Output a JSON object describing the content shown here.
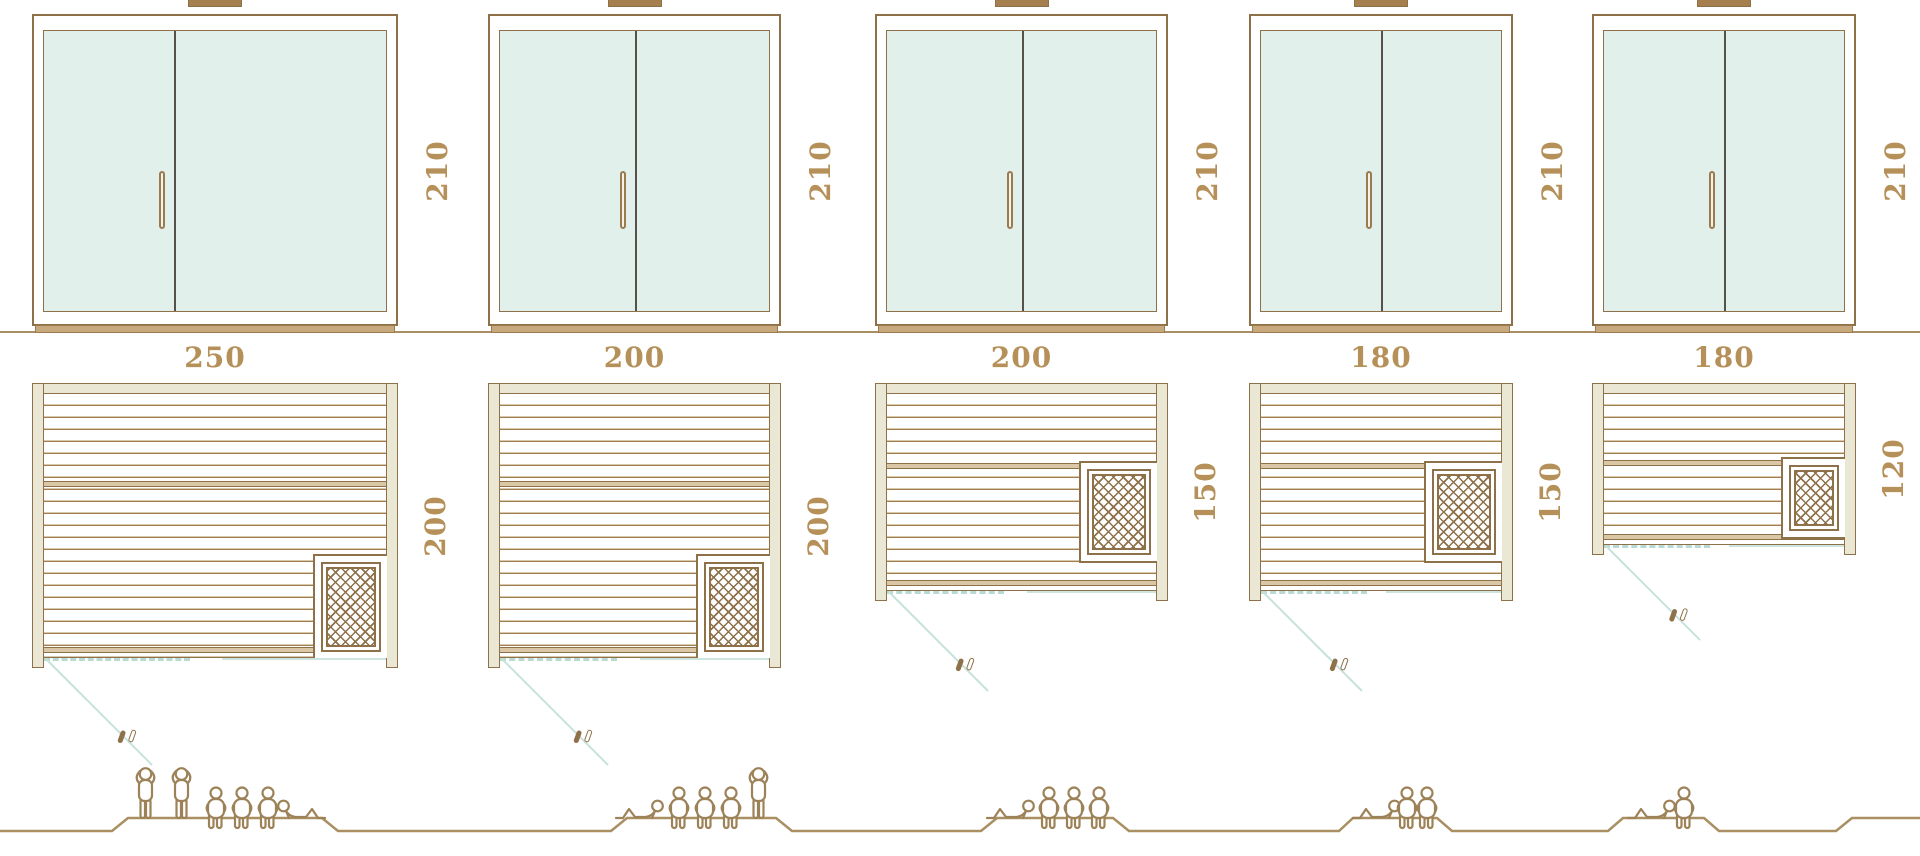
{
  "page": {
    "description": "Technical size-comparison diagram of five sauna cabins: front elevations with glass double doors (height 210), floor plans with bench planks, corner heater, door swing, and human figures indicating capacity."
  },
  "units": [
    {
      "name": "sauna-250x200",
      "elevation_height_label": "210",
      "plan_width_label": "250",
      "plan_depth_label": "200",
      "capacity_figures": [
        "standing",
        "standing",
        "sitting",
        "sitting",
        "sitting",
        "lying"
      ],
      "capacity_total": 6
    },
    {
      "name": "sauna-200x200",
      "elevation_height_label": "210",
      "plan_width_label": "200",
      "plan_depth_label": "200",
      "capacity_figures": [
        "lying",
        "sitting",
        "sitting",
        "sitting",
        "standing"
      ],
      "capacity_total": 5
    },
    {
      "name": "sauna-200x150",
      "elevation_height_label": "210",
      "plan_width_label": "200",
      "plan_depth_label": "150",
      "capacity_figures": [
        "lying",
        "sitting",
        "sitting",
        "sitting"
      ],
      "capacity_total": 4
    },
    {
      "name": "sauna-180x150",
      "elevation_height_label": "210",
      "plan_width_label": "180",
      "plan_depth_label": "150",
      "capacity_figures": [
        "lying",
        "sitting",
        "sitting"
      ],
      "capacity_total": 3
    },
    {
      "name": "sauna-180x120",
      "elevation_height_label": "210",
      "plan_width_label": "180",
      "plan_depth_label": "120",
      "capacity_figures": [
        "lying",
        "sitting"
      ],
      "capacity_total": 2
    }
  ],
  "colors": {
    "outline_brown": "#8e7049",
    "glass_fill": "#e2f0ec",
    "wall_fill": "#eae7d5",
    "dimension_text": "#b59059",
    "door_swing_teal": "#c7e2dc",
    "sill_tan": "#c8a87d",
    "door_divider_dark": "#55524b",
    "people_outline": "#9d8258",
    "ground_line": "#a98f62"
  }
}
